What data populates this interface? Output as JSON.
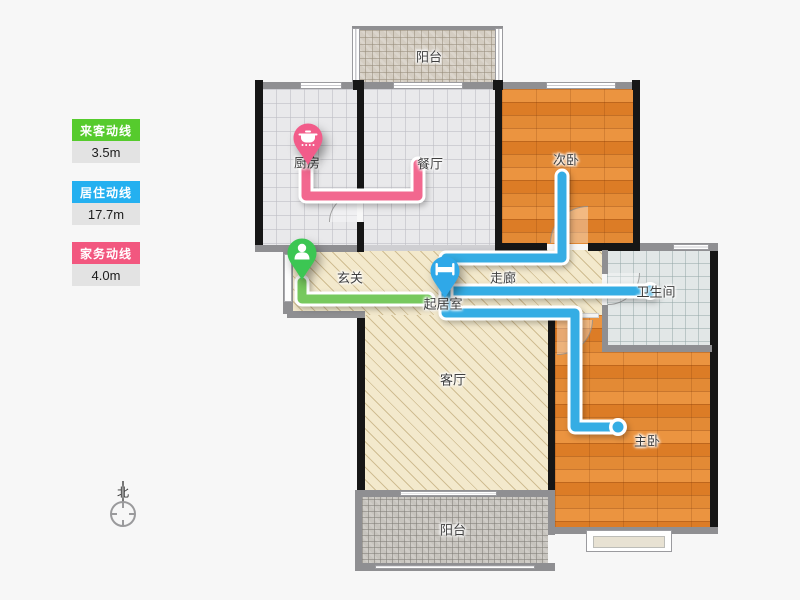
{
  "legend": {
    "items": [
      {
        "label": "来客动线",
        "value": "3.5m",
        "color": "#56cb2d"
      },
      {
        "label": "居住动线",
        "value": "17.7m",
        "color": "#24b0f0"
      },
      {
        "label": "家务动线",
        "value": "4.0m",
        "color": "#f2577f"
      }
    ]
  },
  "compass": {
    "label": "北"
  },
  "rooms": {
    "balcony_top": "阳台",
    "kitchen": "厨房",
    "dining": "餐厅",
    "bedroom2": "次卧",
    "entry": "玄关",
    "corridor": "走廊",
    "living_hall": "起居室",
    "bathroom": "卫生间",
    "living": "客厅",
    "master": "主卧",
    "balcony_bottom": "阳台"
  },
  "routes": {
    "visitor": {
      "color": "#77c95e",
      "points": [
        "302,282 302,299 428,299"
      ]
    },
    "living": {
      "color": "#35ade4",
      "points": [
        "446,276 446,258 562,258 562,176",
        "446,276 446,291 650,291",
        "446,276 446,313 575,313 575,427 618,427"
      ],
      "end_dots": [
        [
          650,
          291
        ],
        [
          618,
          427
        ]
      ]
    },
    "chores": {
      "color": "#f2688f",
      "points": [
        "306,168 306,196 418,196 418,164"
      ]
    }
  },
  "pins": {
    "kitchen": {
      "icon": "pot-icon",
      "color": "#f25c8a"
    },
    "entry": {
      "icon": "person-icon",
      "color": "#3cc653"
    },
    "living": {
      "icon": "bed-icon",
      "color": "#2fa8e8"
    }
  }
}
